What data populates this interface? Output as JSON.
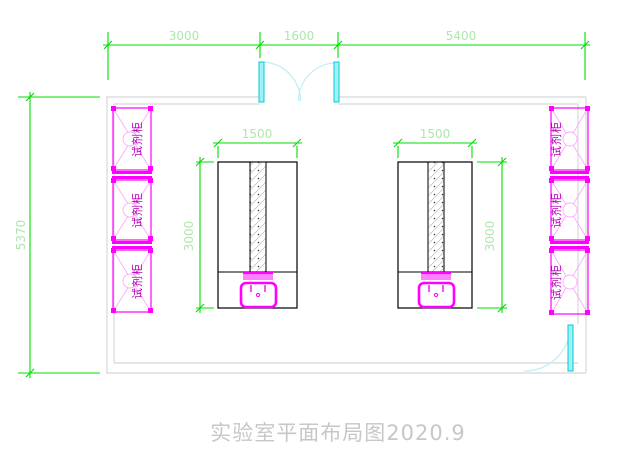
{
  "drawing": {
    "title": "实验室平面布局图2020.9",
    "dimensions": {
      "top": {
        "left_span": "3000",
        "door_span": "1600",
        "right_span": "5400"
      },
      "side": {
        "room_depth": "5370"
      },
      "bench": {
        "width": "1500",
        "depth": "3000"
      }
    },
    "cabinets": {
      "label": "试剂柜"
    },
    "colors": {
      "dimension_line_green": "#00dc00",
      "dimension_text_green": "#aee6ae",
      "cabinet_magenta": "#ff00ff",
      "cabinet_text_magenta": "#b400b4",
      "door_leaf_cyan": "#00ccd8",
      "door_arc_pale_cyan": "#bdeef4",
      "wall_gray": "#d8d8d8",
      "bench_outline_black": "#000000",
      "title_gray": "#c7c7c7"
    }
  }
}
